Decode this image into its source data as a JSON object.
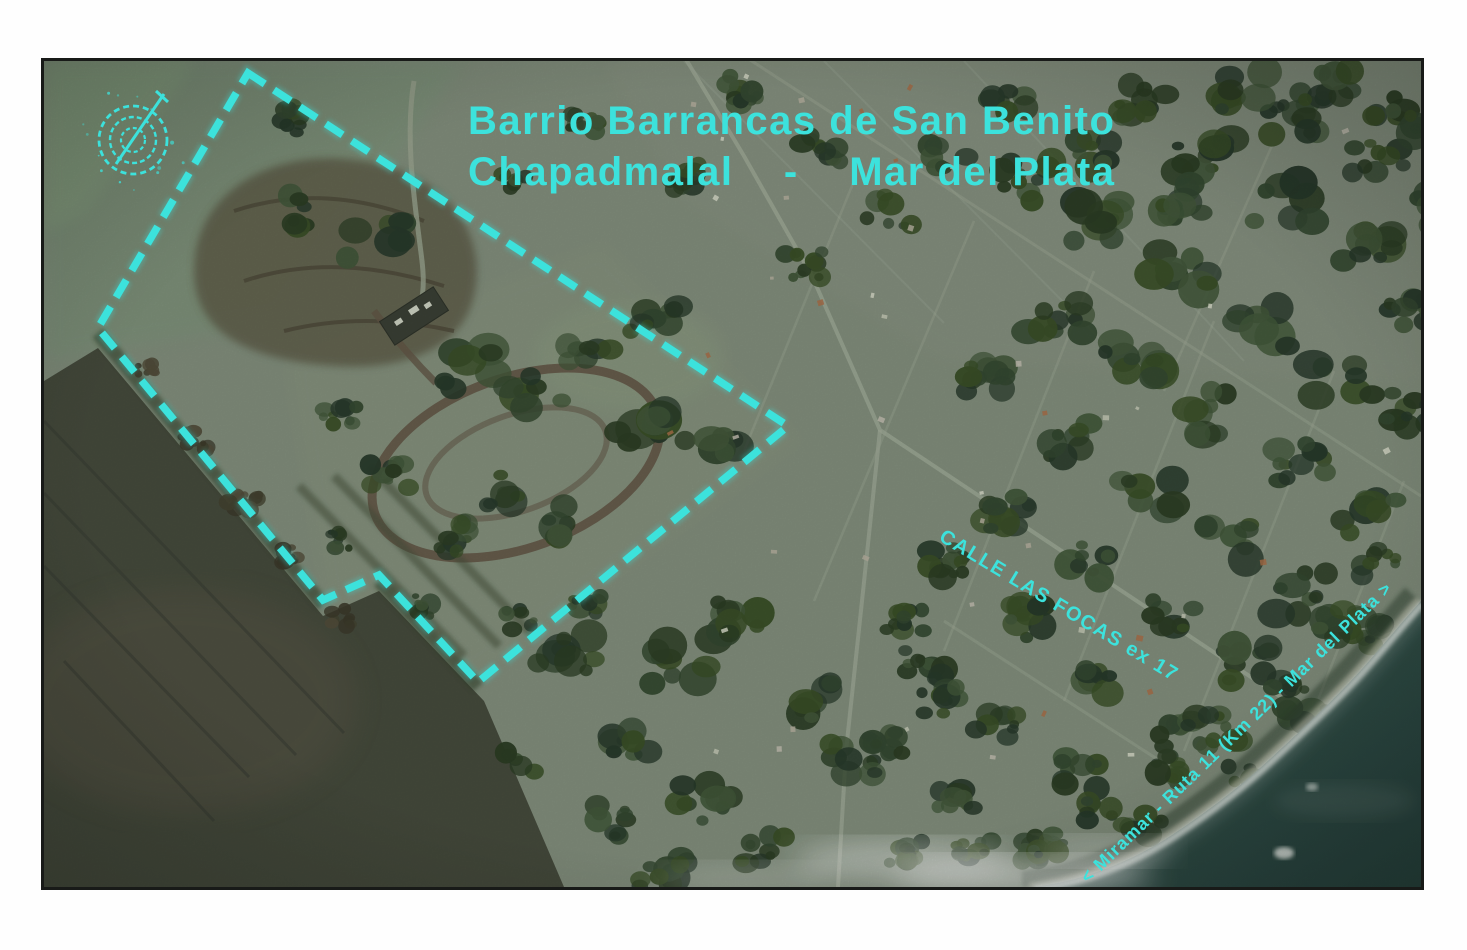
{
  "map": {
    "title": {
      "line1": "Barrio Barrancas de San Benito",
      "line2": "Chapadmalal    -    Mar del Plata"
    },
    "labels": {
      "calle": "CALLE LAS FOCAS ex 17",
      "ruta": "< Miramar - Ruta 11 (Km 22) - Mar del Plata >"
    },
    "colors": {
      "annotation": "#3ce2dc",
      "sea": "#27463e",
      "field": "#7e8b78"
    },
    "icons": {
      "compass": "compass-rose-icon"
    }
  }
}
